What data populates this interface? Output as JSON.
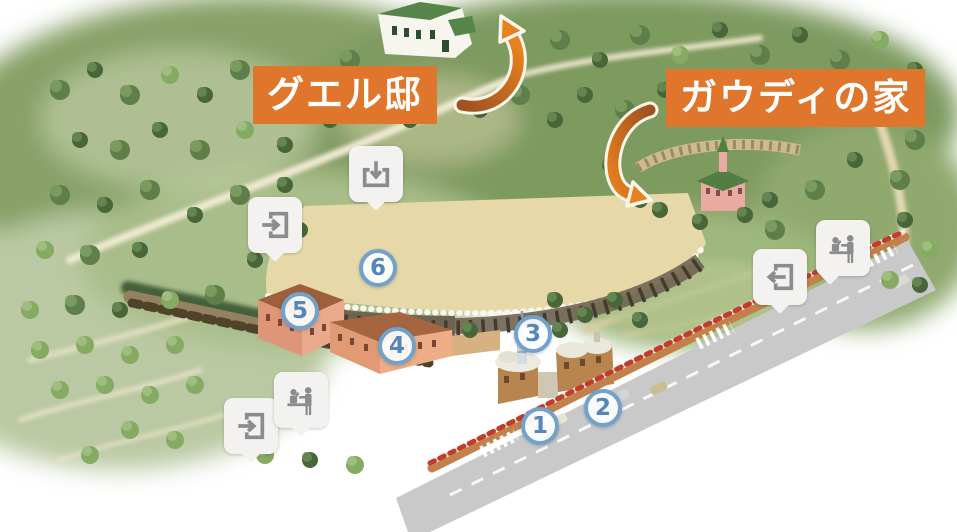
{
  "labels": {
    "guell_mansion": "グエル邸",
    "gaudi_house": "ガウディの家"
  },
  "markers": [
    {
      "number": "1"
    },
    {
      "number": "2"
    },
    {
      "number": "3"
    },
    {
      "number": "4"
    },
    {
      "number": "5"
    },
    {
      "number": "6"
    }
  ],
  "icon_markers": [
    {
      "icon": "entrance-icon"
    },
    {
      "icon": "entrance-down-icon"
    },
    {
      "icon": "exit-icon"
    },
    {
      "icon": "ticket-counter-icon"
    },
    {
      "icon": "entrance-icon"
    },
    {
      "icon": "ticket-counter-icon"
    }
  ],
  "colors": {
    "accent_orange": "#e0752c",
    "arrow_orange_dark": "#9e5120",
    "arrow_orange": "#e8811f",
    "marker_number_blue": "#5486ba",
    "marker_border_blue": "#73a1ca",
    "icon_gray": "#8c8c8c"
  }
}
